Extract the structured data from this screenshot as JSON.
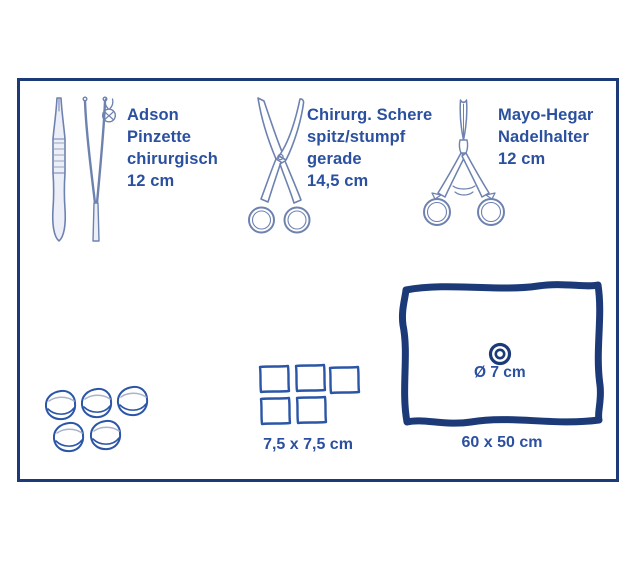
{
  "colors": {
    "frame": "#1d3a78",
    "text": "#2b509f",
    "outline": "#6e82b0",
    "fill": "#eceff7",
    "shade": "#a9b3c9",
    "supply": "#2b55a6",
    "drape": "#1d3a78"
  },
  "instruments": [
    {
      "id": "adson-forceps",
      "icon": "forceps-teeth-icon",
      "lines": [
        "Adson",
        "Pinzette",
        "chirurgisch",
        "12 cm"
      ]
    },
    {
      "id": "surgical-scissors",
      "lines": [
        "Chirurg. Schere",
        "spitz/stumpf",
        "gerade",
        "14,5 cm"
      ]
    },
    {
      "id": "mayo-hegar-needle-holder",
      "lines": [
        "Mayo-Hegar",
        "Nadelhalter",
        "12 cm"
      ]
    }
  ],
  "supplies": {
    "swabs": {
      "count": 5
    },
    "gauze_compresses": {
      "count": 5,
      "label": "7,5 x 7,5 cm"
    },
    "drape": {
      "hole_label": "Ø 7 cm",
      "label": "60 x 50 cm"
    }
  }
}
